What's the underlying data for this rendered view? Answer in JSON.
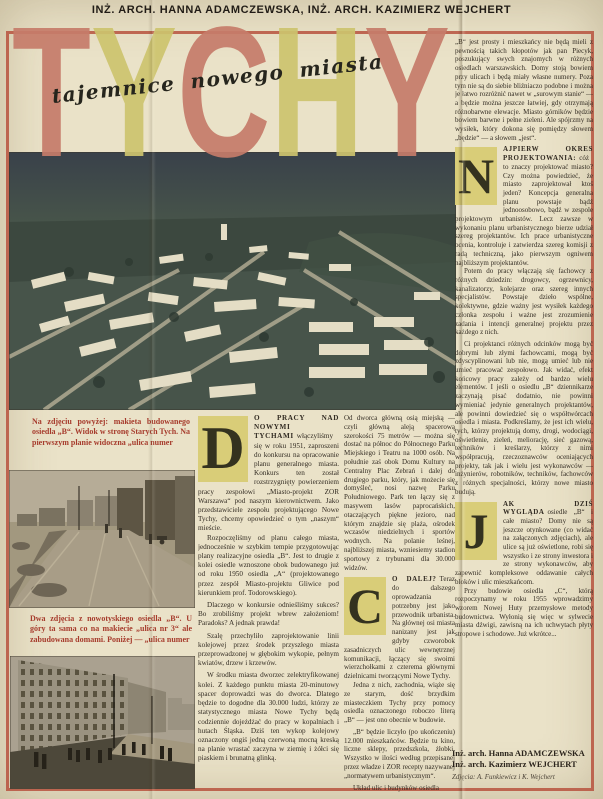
{
  "header": {
    "authors": "INŻ. ARCH. HANNA ADAMCZEWSKA, INŻ. ARCH. KAZIMIERZ WEJCHERT"
  },
  "masthead": {
    "letters": [
      {
        "char": "T",
        "color": "#c67c6a"
      },
      {
        "char": "Y",
        "color": "#cdc46e"
      },
      {
        "char": "C",
        "color": "#c67c6a"
      },
      {
        "char": "H",
        "color": "#cdc46e"
      },
      {
        "char": "Y",
        "color": "#c67c6a"
      }
    ],
    "subtitle": "tajemnice nowego miasta"
  },
  "colors": {
    "paper": "#eae2c8",
    "frame": "#b7523e",
    "caption_red": "#a63b2c",
    "dropcap_bg": "#d9cd78"
  },
  "left_column": {
    "caption_top": "Na zdjęciu powyżej: makieta budowanego osiedla „B“. Widok w stronę Starych Tych. Na pierwszym planie widoczna „ulica numer",
    "caption_mid": "Dwa zdjęcia z nowotyskiego osiedla „B“. U góry ta sama co na makiecie „ulica nr 3“ ale zabudowana domami. Poniżej — „ulica numer"
  },
  "column_d": {
    "dropcap": "D",
    "lead_caps": "O PRACY NAD NOWYMI TYCHAMI",
    "lead_rest": "włączyliśmy się w roku 1951, zaproszeni do konkursu na opracowanie planu generalnego miasta. Konkurs ten został rozstrzygnięty powierzeniem pracy zespołowi „Miasto-projekt ZOR Warszawa“ pod naszym kierownictwem. Jako przedstawiciele zespołu projektującego Nowe Tychy, chcemy opowiedzieć o tym „naszym“ mieście.",
    "p2": "Rozpoczęliśmy od planu całego miasta, jednocześnie w szybkim tempie przygotowując plany realizacyjne osiedla „B“. Jest to drugie z kolei osiedle wznoszone obok budowanego już od roku 1950 osiedla „A“ (projektowanego przez zespół Miasto-projektu Gliwice pod kierunkiem prof. Todorowskiego).",
    "p3": "Dlaczego w konkursie odnieśliśmy sukces? Bo zrobiliśmy projekt wbrew założeniom! Paradoks? A jednak prawda!",
    "p4": "Szalę przechyliło zaprojektowanie linii kolejowej przez środek przyszłego miasta przeprowadzonej w głębokim wykopie, pełnym kwiatów, drzew i krzewów.",
    "p5": "W środku miasta dworzec zelektryfikowanej kolei. Z każdego punktu miasta 20-minutowy spacer doprowadzi was do dworca. Dlatego będzie to dogodne dla 30.000 ludzi, którzy ze statystycznego miasta Nowe Tychy będą codziennie dojeżdżać do pracy w kopalniach i hutach Śląska. Dziś ten wykop kolejowy oznaczony ongiś jedną czerwoną mocną kreską na planie wrastać zaczyna w ziemię i żółci się piaskiem i brunatną glinką."
  },
  "column_c": {
    "p1": "Od dworca główną osią miejską — czyli główną aleją spacerową szerokości 75 metrów — można się dostać na północ do Północnego Parku Miejskiego i Teatru na 1000 osób. Na południe zaś obok Domu Kultury na Centralny Plac Zebrań i dalej do drugiego parku, który, jak możecie się domyśleć, nosi nazwę Parku Południowego. Park ten łączy się z masywem lasów paprocańskich, otaczających piękne jezioro, nad którym znajdzie się plaża, ośrodek wczasów niedzielnych i sportów wodnych. Na polanie leśnej, najbliższej miasta, wzniesiemy stadion sportowy z trybunami dla 30.000 widzów.",
    "dropcap": "C",
    "lead_caps": "O DALEJ?",
    "lead_rest": "Teraz do dalszego oprowadzania potrzebny jest jako przewodnik urbanista. Na głównej osi miasta nanizany jest jak gdyby czworobok zasadniczych ulic wewnętrznej komunikacji, łączący się swoimi wierzchołkami z czterema głównymi dzielnicami tworzącymi Nowe Tychy.",
    "p3": "Jedna z nich, zachodnia, wiąże się ze starym, dość brzydkim miasteczkiem Tychy przy pomocy osiedla oznaczonego roboczo literą „B“ — jest ono obecnie w budowie.",
    "p4": "„B“ będzie liczyło (po ukończeniu) 12.000 mieszkańców. Będzie tu kino, liczne sklepy, przedszkola, żłobki. Wszystko w ilości według przepisanej przez władze i ZOR recepty nazywanej „normatywem urbanistycznym“.",
    "p5": "Układ ulic i budynków osiedla"
  },
  "right_column": {
    "p1": "„B“ jest prosty i mieszkańcy nie będą mieli z pewnością takich kłopotów jak pan Piecyk, poszukujący swych znajomych w różnych osiedlach warszawskich. Domy stoją bowiem przy ulicach i będą miały własne numery. Poza tym nie są do siebie bliźniaczo podobne i można je łatwo rozróżnić nawet w „surowym stanie“ — a będzie można jeszcze łatwiej, gdy otrzymają różnobarwne elewacje. Miasto górników będzie bowiem barwne i pełne zieleni. Ale spójrzmy na wysiłek, który dokona się pomiędzy słowem „będzie“ — a słowem „jest“.",
    "n": {
      "dropcap": "N",
      "lead_caps": "AJPIERW OKRES PROJEKTOWANIA:",
      "lead_rest": "cóż to znaczy projektować miasto? Czy można powiedzieć, że miasto zaprojektował ktoś jeden? Koncepcja generalna planu powstaje bądź jednoosobowo, bądź w zespole projektowym urbanistów. Lecz zawsze w wykonaniu planu urbanistycznego bierze udział szereg projektantów. Ich prace urbanistyczne ocenia, kontroluje i zatwierdza szereg komisji z radą techniczną, jako pierwszym ogniwem najbliższym projektantów."
    },
    "p2": "Potem do pracy włączają się fachowcy z różnych dziedzin: drogowcy, ogrzewnicy, kanalizatorzy, kolejarze oraz szereg innych specjalistów. Powstaje dzieło wspólne, kolektywne, gdzie ważny jest wysiłek każdego członka zespołu i ważne jest zrozumienie zadania i intencji generalnej projektu przez każdego z nich.",
    "p3": "Ci projektanci różnych odcinków mogą być dobrymi lub złymi fachowcami, mogą być zdyscyplinowani lub nie, mogą umieć lub nie umieć pracować zespołowo. Jak widać, efekt końcowy pracy zależy od bardzo wielu elementów. I jeśli o osiedlu „B“ dziennikarze zaczynają pisać dodatnio, nie powinni wymieniać jedynie generalnych projektantów, ale powinni dowiedzieć się o współtwórcach osiedla i miasta. Podkreślamy, że jest ich wielu, tych, którzy projektują domy, drogi, wodociągi, oświetlenie, zieleń, meliorację, sieć gazową, techników i kreślarzy, którzy z nimi współpracują, rzeczoznawców oceniających projekty, tak jak i wielu jest wykonawców — inżynierów, robotników, techników, fachowców z różnych specjalności, którzy nowe miasto budują.",
    "j": {
      "dropcap": "J",
      "lead_caps": "AK DZIŚ WYGLĄDA",
      "lead_rest": "osiedle „B“ i całe miasto? Domy nie są jeszcze otynkowane (co widać na załączonych zdjęciach), ale ulice są już oświetlone, robi się wszystko i ze strony inwestora i ze strony wykonawców, aby zapewnić kompleksowe oddawanie całych bloków i ulic mieszkańcom."
    },
    "p4": "Przy budowie osiedla „C“, którą rozpoczynamy w roku 1955 wprowadzimy wzorem Nowej Huty przemysłowe metody budownictwa. Wyłonią się więc w sylwecie miasta dźwigi, zawisną na ich uchwytach płyty stropowe i schodowe. Już wkrótce..."
  },
  "signature": {
    "line1": "Inż. arch. Hanna ADAMCZEWSKA",
    "line2": "Inż. arch. Kazimierz WEJCHERT",
    "credit": "Zdjęcia: A. Funkiewicz i K. Wejchert"
  }
}
